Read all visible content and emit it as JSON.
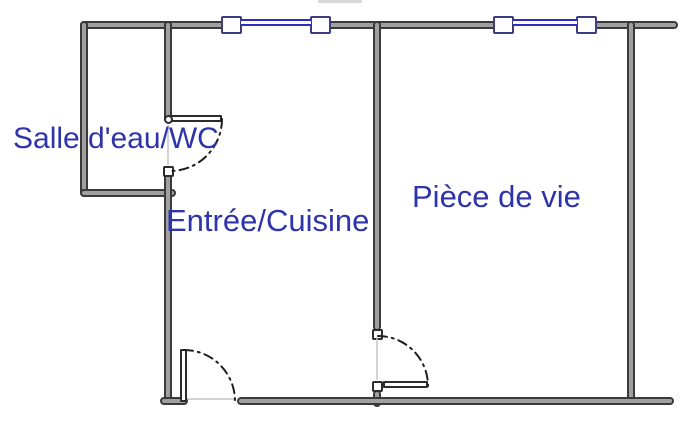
{
  "plan": {
    "colors": {
      "wall_edge": "#3a3a3a",
      "wall_fill": "#a0a0a0",
      "window_glass": "#2d2dc4",
      "window_frame": "#3c3c80",
      "label": "#2f34ab",
      "arc": "#1f1f1f",
      "opening": "#c6c6c6",
      "background": "#ffffff"
    },
    "rooms": [
      {
        "name": "salle-deau-wc",
        "label": "Salle d'eau/WC"
      },
      {
        "name": "entree-cuisine",
        "label": "Entrée/Cuisine"
      },
      {
        "name": "piece-de-vie",
        "label": "Pièce de vie"
      }
    ],
    "walls": [
      {
        "name": "top-wall",
        "x": 80,
        "y": 21,
        "w": 598,
        "h": 8
      },
      {
        "name": "bathroom-left-wall",
        "x": 80,
        "y": 21,
        "w": 8,
        "h": 176
      },
      {
        "name": "bathroom-bottom-wall",
        "x": 80,
        "y": 189,
        "w": 96,
        "h": 8
      },
      {
        "name": "hall-left-wall-upper",
        "x": 164,
        "y": 21,
        "w": 8,
        "h": 102
      },
      {
        "name": "hall-left-wall-lower",
        "x": 164,
        "y": 166,
        "w": 8,
        "h": 239
      },
      {
        "name": "partition-wall-upper",
        "x": 373,
        "y": 21,
        "w": 8,
        "h": 310
      },
      {
        "name": "partition-wall-stub",
        "x": 373,
        "y": 390,
        "w": 8,
        "h": 17
      },
      {
        "name": "right-wall",
        "x": 627,
        "y": 21,
        "w": 8,
        "h": 384
      },
      {
        "name": "bottom-wall-left",
        "x": 160,
        "y": 397,
        "w": 28,
        "h": 8
      },
      {
        "name": "bottom-wall-main",
        "x": 237,
        "y": 397,
        "w": 437,
        "h": 8
      }
    ],
    "windows": [
      {
        "name": "window-1",
        "x": 221,
        "y": 16,
        "w": 110,
        "h": 18
      },
      {
        "name": "window-2",
        "x": 493,
        "y": 16,
        "w": 104,
        "h": 18
      }
    ],
    "door_jambs": [
      [
        163,
        166
      ],
      [
        372,
        329
      ],
      [
        372,
        381
      ]
    ],
    "door_leaves": [
      {
        "name": "bathroom-door-leaf",
        "x": 169,
        "y": 115,
        "w": 53,
        "h": 7
      },
      {
        "name": "entrance-door-leaf",
        "x": 180,
        "y": 349,
        "w": 7,
        "h": 53
      },
      {
        "name": "living-door-leaf",
        "x": 383,
        "y": 381,
        "w": 45,
        "h": 7
      }
    ],
    "door_hinges": [
      [
        164,
        115
      ]
    ],
    "door_arcs": [
      {
        "name": "bathroom-door-swing",
        "d": "M 222 119 A 52 52 0 0 1 170 171"
      },
      {
        "name": "entrance-door-swing",
        "d": "M 184 350 A 51 51 0 0 1 235 401"
      },
      {
        "name": "living-door-swing",
        "d": "M 378 336 A 50 50 0 0 1 428 386"
      }
    ],
    "opening_lines": [
      {
        "x1": 168,
        "y1": 125,
        "x2": 168,
        "y2": 165
      },
      {
        "x1": 188,
        "y1": 399,
        "x2": 236,
        "y2": 399
      },
      {
        "x1": 377,
        "y1": 337,
        "x2": 377,
        "y2": 380
      }
    ],
    "artifacts": [
      {
        "x": 318,
        "y": 0,
        "w": 44,
        "h": 3,
        "color": "#d8d8d8"
      }
    ]
  }
}
